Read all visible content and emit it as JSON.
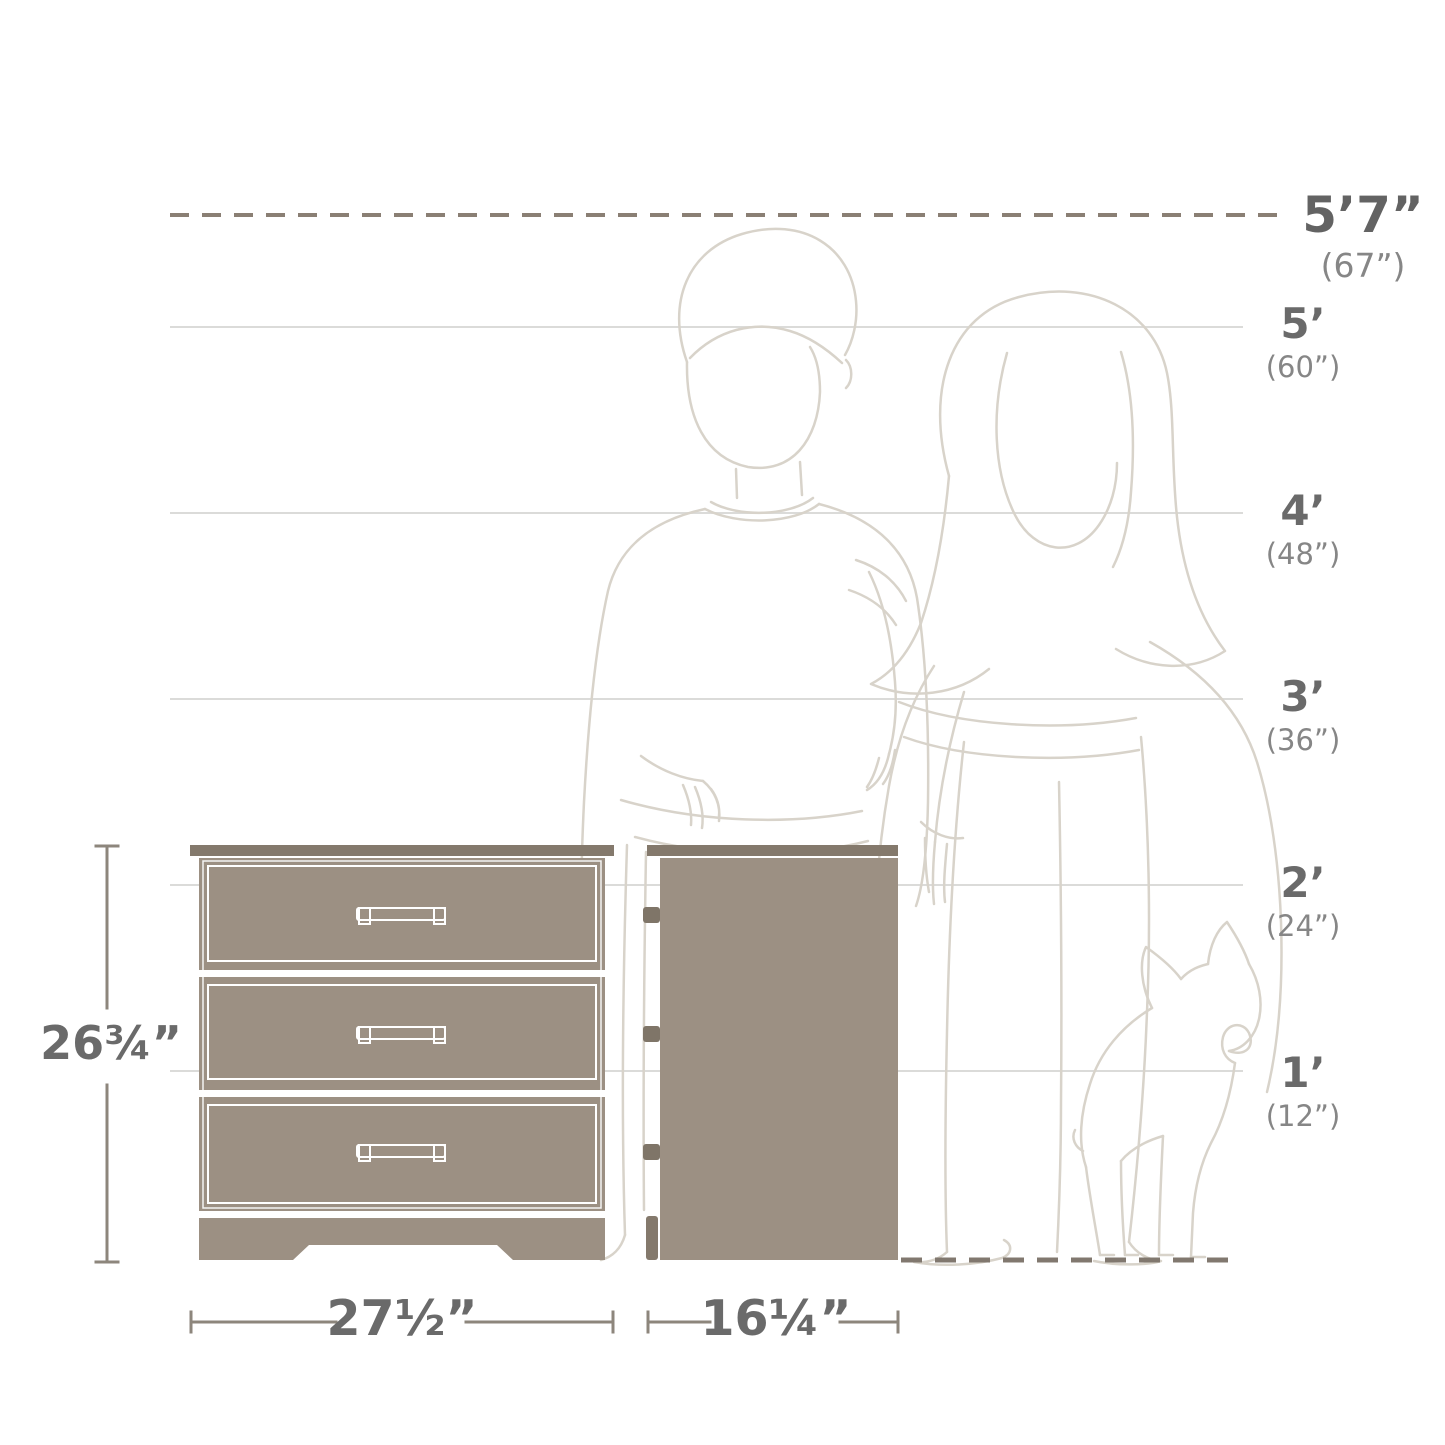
{
  "diagram": {
    "kind": "furniture dimension comparison diagram",
    "product": {
      "name": "3-drawer chest (front and side view)",
      "height_label": "26¾”",
      "width_label": "27½”",
      "depth_label": "16¼”",
      "drawer_count": 3
    },
    "scale": {
      "max_height": {
        "label": "5’7”",
        "inches": "(67”)"
      },
      "marks": [
        {
          "label": "5’",
          "inches": "(60”)"
        },
        {
          "label": "4’",
          "inches": "(48”)"
        },
        {
          "label": "3’",
          "inches": "(36”)"
        },
        {
          "label": "2’",
          "inches": "(24”)"
        },
        {
          "label": "1’",
          "inches": "(12”)"
        }
      ]
    },
    "figures": [
      "man-outline",
      "woman-outline",
      "french-bulldog-outline"
    ],
    "colors": {
      "furniture_body": "#9c9083",
      "furniture_dark": "#84796c",
      "drawer_outline": "#ffffff",
      "gridline": "#dbdbd9",
      "dashed_line": "#8a7f74",
      "ground_dash": "#81786f",
      "dimension_line": "#8d867c",
      "figure_line": "#d8d3ca",
      "text_primary": "#6a6a6a",
      "text_secondary": "#868686"
    }
  }
}
